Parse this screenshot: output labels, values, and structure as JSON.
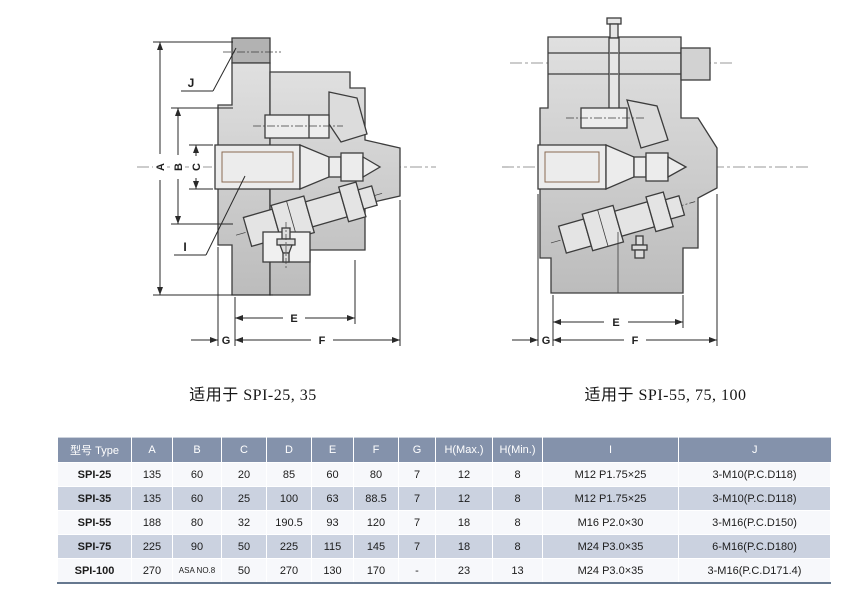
{
  "diagrams": {
    "left": {
      "caption": "适用于 SPI-25, 35",
      "labels": {
        "A": "A",
        "B": "B",
        "C": "C",
        "E": "E",
        "F": "F",
        "G": "G",
        "I": "I",
        "J": "J"
      }
    },
    "right": {
      "caption": "适用于 SPI-55, 75, 100",
      "labels": {
        "E": "E",
        "F": "F",
        "G": "G"
      }
    }
  },
  "table": {
    "headers": [
      "型号 Type",
      "A",
      "B",
      "C",
      "D",
      "E",
      "F",
      "G",
      "H(Max.)",
      "H(Min.)",
      "I",
      "J"
    ],
    "rows": [
      [
        "SPI-25",
        "135",
        "60",
        "20",
        "85",
        "60",
        "80",
        "7",
        "12",
        "8",
        "M12 P1.75×25",
        "3-M10(P.C.D118)"
      ],
      [
        "SPI-35",
        "135",
        "60",
        "25",
        "100",
        "63",
        "88.5",
        "7",
        "12",
        "8",
        "M12 P1.75×25",
        "3-M10(P.C.D118)"
      ],
      [
        "SPI-55",
        "188",
        "80",
        "32",
        "190.5",
        "93",
        "120",
        "7",
        "18",
        "8",
        "M16 P2.0×30",
        "3-M16(P.C.D150)"
      ],
      [
        "SPI-75",
        "225",
        "90",
        "50",
        "225",
        "115",
        "145",
        "7",
        "18",
        "8",
        "M24 P3.0×35",
        "6-M16(P.C.D180)"
      ],
      [
        "SPI-100",
        "270",
        "ASA NO.8",
        "50",
        "270",
        "130",
        "170",
        "-",
        "23",
        "13",
        "M24 P3.0×35",
        "3-M16(P.C.D171.4)"
      ]
    ],
    "colors": {
      "header_bg": "#8492ab",
      "header_text": "#ffffff",
      "row_odd": "#f7f8fb",
      "row_even": "#cbd2e0",
      "bottom_border": "#66788f"
    }
  }
}
